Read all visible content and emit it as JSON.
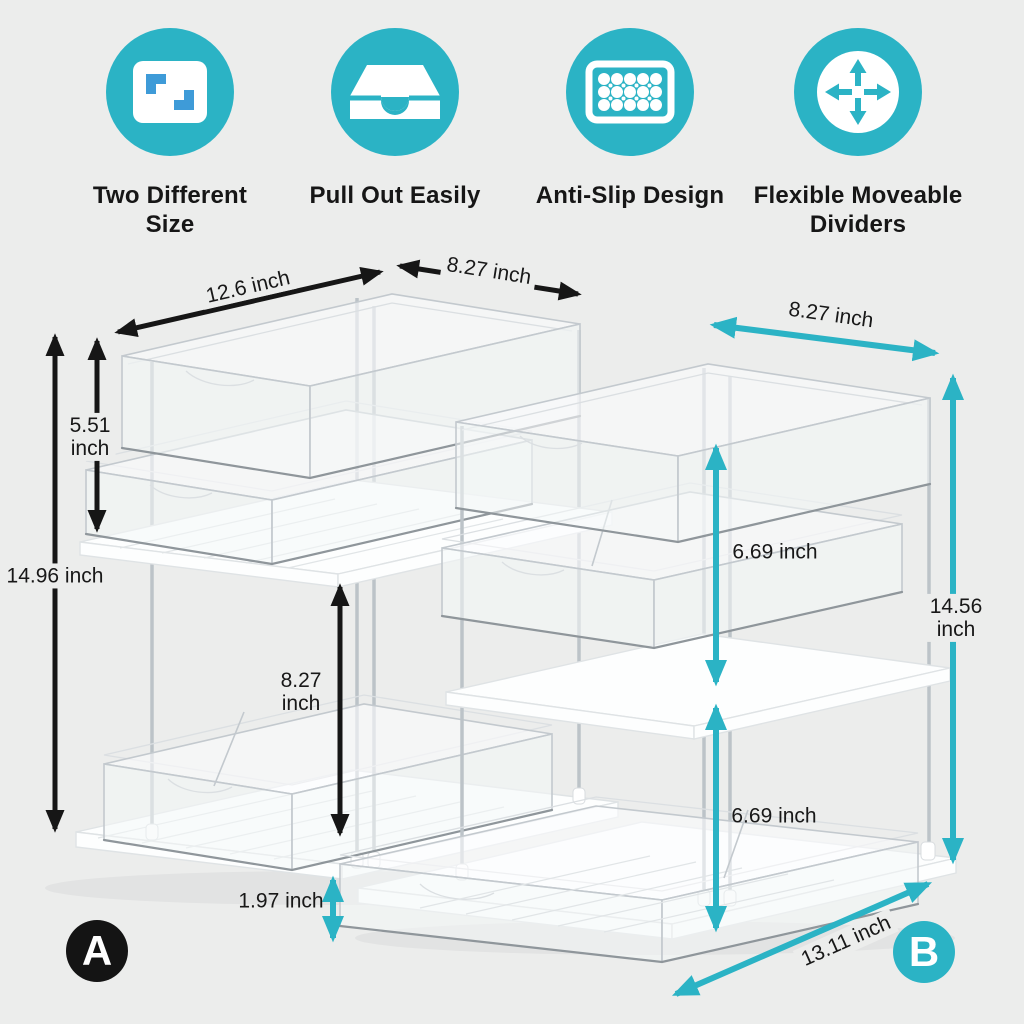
{
  "colors": {
    "background": "#ecedec",
    "teal": "#2bb3c5",
    "ink": "#161616",
    "icon_blue": "#3e9bd8",
    "white": "#ffffff"
  },
  "features": [
    {
      "icon": "two-size-resize-icon",
      "label": "Two Different\nSize"
    },
    {
      "icon": "pull-out-drawer-icon",
      "label": "Pull Out Easily"
    },
    {
      "icon": "anti-slip-mat-icon",
      "label": "Anti-Slip Design"
    },
    {
      "icon": "move-arrows-icon",
      "label": "Flexible Moveable\nDividers"
    }
  ],
  "product_a": {
    "badge": "A",
    "dimensions": {
      "top_width": "12.6 inch",
      "top_depth": "8.27 inch",
      "upper_tier_height": "5.51\ninch",
      "total_height": "14.96 inch",
      "lower_tier_height": "8.27\ninch",
      "tray_height": "1.97 inch"
    }
  },
  "product_b": {
    "badge": "B",
    "dimensions": {
      "top_depth": "8.27 inch",
      "upper_tier_height": "6.69 inch",
      "total_height": "14.56 inch",
      "lower_tier_height": "6.69 inch",
      "base_width": "13.11 inch"
    }
  }
}
